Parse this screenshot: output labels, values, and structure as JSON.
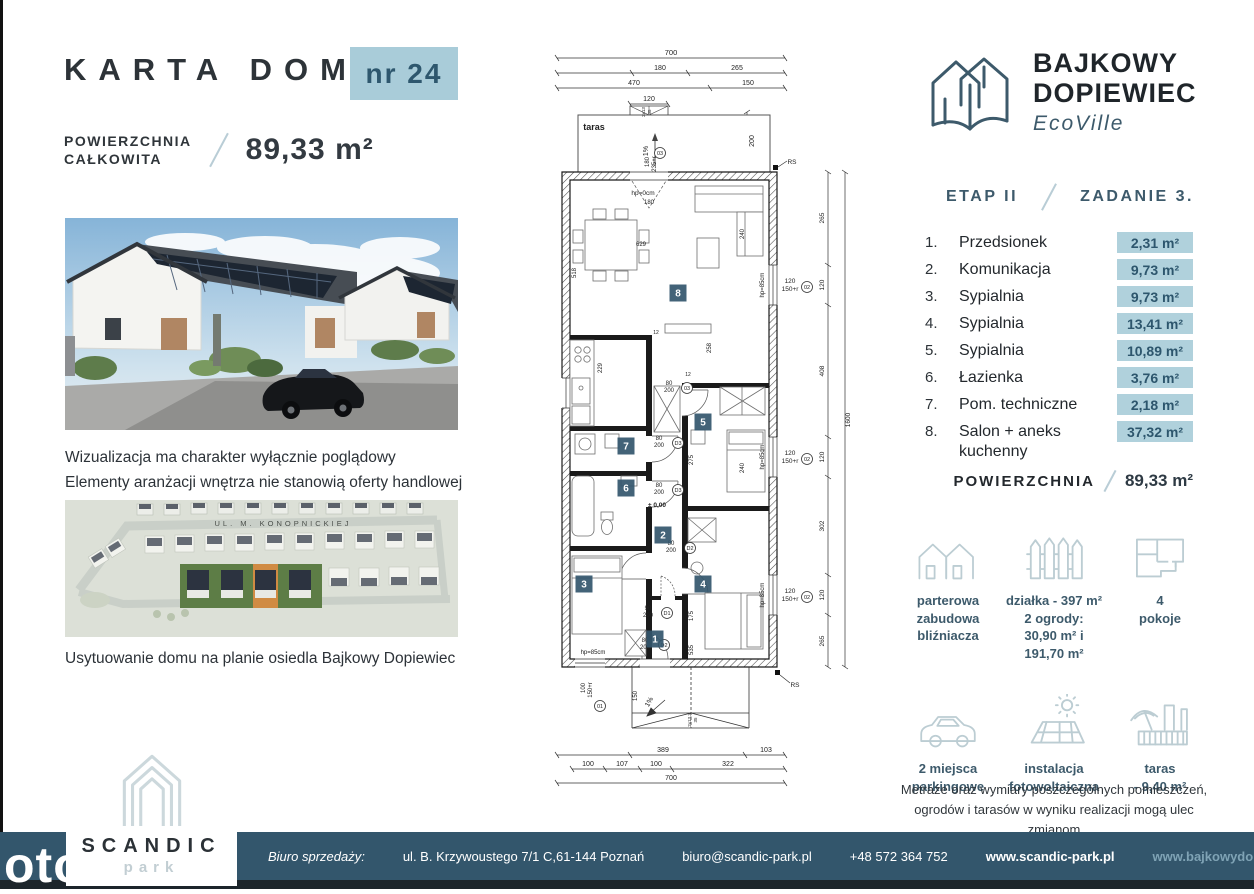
{
  "colors": {
    "accent_slate": "#3d5a6b",
    "badge_bg": "#a9ccd9",
    "badge_text": "#2e576e",
    "area_badge_bg": "#b0d1dc",
    "footer_bg": "#33566c",
    "icon_stroke": "#bccdd3",
    "plan_badge": "#33566c"
  },
  "header": {
    "title": "KARTA DOMU",
    "number_badge": "nr 24",
    "area_label": "POWIERZCHNIA\nCAŁKOWITA",
    "area_value": "89,33 m²"
  },
  "brand": {
    "name_line1": "BAJKOWY",
    "name_line2": "DOPIEWIEC",
    "sub": "EcoVille",
    "etap": "ETAP II",
    "zadanie": "ZADANIE 3."
  },
  "photo": {
    "caption": "Wizualizacja ma charakter wyłącznie poglądowy\nElementy aranżacji wnętrza nie stanowią oferty handlowej"
  },
  "siteplan": {
    "street": "UL. M. KONOPNICKIEJ",
    "caption": "Usytuowanie domu na planie osiedla Bajkowy Dopiewiec"
  },
  "rooms": [
    {
      "no": "1.",
      "name": "Przedsionek",
      "area": "2,31 m²"
    },
    {
      "no": "2.",
      "name": "Komunikacja",
      "area": "9,73 m²"
    },
    {
      "no": "3.",
      "name": "Sypialnia",
      "area": "9,73 m²"
    },
    {
      "no": "4.",
      "name": "Sypialnia",
      "area": "13,41 m²"
    },
    {
      "no": "5.",
      "name": "Sypialnia",
      "area": "10,89 m²"
    },
    {
      "no": "6.",
      "name": "Łazienka",
      "area": "3,76 m²"
    },
    {
      "no": "7.",
      "name": "Pom. techniczne",
      "area": "2,18 m²"
    },
    {
      "no": "8.",
      "name": "Salon + aneks kuchenny",
      "area": "37,32 m²"
    }
  ],
  "summary": {
    "label": "POWIERZCHNIA",
    "value": "89,33 m²"
  },
  "features": [
    {
      "icon": "twin-houses-icon",
      "caption": "parterowa\nzabudowa\nbliźniacza"
    },
    {
      "icon": "fence-icon",
      "caption": "działka - 397 m²\n2 ogrody:\n30,90 m² i 191,70 m²"
    },
    {
      "icon": "floorplan-icon",
      "caption": "4\npokoje"
    },
    {
      "icon": "car-icon",
      "caption": "2 miejsca\nparkingowe"
    },
    {
      "icon": "solar-panel-icon",
      "caption": "instalacja\nfotowoltaiczna"
    },
    {
      "icon": "terrace-umbrella-icon",
      "caption": "taras\n- 9,40 m²"
    }
  ],
  "disclaimer": "Metraże oraz wymiary poszczególnych pomieszczeń,\nogrodów i tarasów w wyniku realizacji mogą ulec zmianom",
  "footer": {
    "label": "Biuro sprzedaży:",
    "address": "ul. B. Krzywoustego 7/1 C,61-144 Poznań",
    "email": "biuro@scandic-park.pl",
    "phone": "+48 572 364 752",
    "site1": "www.scandic-park.pl",
    "site2": "www.bajkowydopiewiec.pl"
  },
  "scandic": {
    "name": "SCANDIC",
    "sub": "park"
  },
  "watermark": "oto",
  "plan": {
    "room_badges": [
      {
        "n": "1",
        "x": 110,
        "y": 601
      },
      {
        "n": "2",
        "x": 118,
        "y": 497
      },
      {
        "n": "3",
        "x": 39,
        "y": 546
      },
      {
        "n": "4",
        "x": 158,
        "y": 546
      },
      {
        "n": "5",
        "x": 158,
        "y": 384
      },
      {
        "n": "6",
        "x": 81,
        "y": 450
      },
      {
        "n": "7",
        "x": 81,
        "y": 408
      },
      {
        "n": "8",
        "x": 133,
        "y": 255
      }
    ],
    "circle_labels": [
      {
        "t": "03",
        "x": 115,
        "y": 115
      },
      {
        "t": "03",
        "x": 142,
        "y": 350
      },
      {
        "t": "02",
        "x": 262,
        "y": 249
      },
      {
        "t": "02",
        "x": 262,
        "y": 421
      },
      {
        "t": "02",
        "x": 262,
        "y": 559
      },
      {
        "t": "D3",
        "x": 133,
        "y": 405
      },
      {
        "t": "D3",
        "x": 133,
        "y": 452
      },
      {
        "t": "D2",
        "x": 145,
        "y": 510
      },
      {
        "t": "D1",
        "x": 122,
        "y": 575
      },
      {
        "t": "D2",
        "x": 119,
        "y": 607
      },
      {
        "t": "01",
        "x": 55,
        "y": 668
      }
    ],
    "texts": [
      {
        "t": "700",
        "x": 126,
        "y": 17,
        "s": 7.5
      },
      {
        "t": "180",
        "x": 115,
        "y": 32,
        "s": 7
      },
      {
        "t": "265",
        "x": 192,
        "y": 32,
        "s": 7
      },
      {
        "t": "470",
        "x": 89,
        "y": 47,
        "s": 7
      },
      {
        "t": "150",
        "x": 203,
        "y": 47,
        "s": 7
      },
      {
        "t": "120",
        "x": 104,
        "y": 63,
        "s": 7
      },
      {
        "t": "2x13",
        "x": 100,
        "y": 74,
        "s": 4.5,
        "r": -90
      },
      {
        "t": "35",
        "x": 106,
        "y": 74,
        "s": 4.5,
        "r": -90
      },
      {
        "t": "taras",
        "x": 49,
        "y": 92,
        "s": 9,
        "b": 1
      },
      {
        "t": "1%",
        "x": 103,
        "y": 113,
        "s": 7,
        "r": -90
      },
      {
        "t": "200",
        "x": 209,
        "y": 103,
        "s": 7,
        "r": -90
      },
      {
        "t": "180",
        "x": 104,
        "y": 124,
        "s": 6,
        "r": -90
      },
      {
        "t": "235+r",
        "x": 111,
        "y": 126,
        "s": 6,
        "r": -90
      },
      {
        "t": "hp=0cm",
        "x": 98,
        "y": 157,
        "s": 6.5
      },
      {
        "t": "180",
        "x": 104,
        "y": 166,
        "s": 6
      },
      {
        "t": "629",
        "x": 96,
        "y": 208,
        "s": 6
      },
      {
        "t": "518",
        "x": 31,
        "y": 235,
        "r": -90,
        "s": 6
      },
      {
        "t": "240",
        "x": 199,
        "y": 196,
        "r": -90,
        "s": 6
      },
      {
        "t": "258",
        "x": 166,
        "y": 310,
        "r": -90,
        "s": 6
      },
      {
        "t": "229",
        "x": 57,
        "y": 330,
        "r": -90,
        "s": 6
      },
      {
        "t": "275",
        "x": 148,
        "y": 422,
        "r": -90,
        "s": 6
      },
      {
        "t": "240",
        "x": 199,
        "y": 430,
        "r": -90,
        "s": 6
      },
      {
        "t": "175",
        "x": 148,
        "y": 578,
        "r": -90,
        "s": 6
      },
      {
        "t": "535",
        "x": 148,
        "y": 612,
        "r": -90,
        "s": 6
      },
      {
        "t": "12",
        "x": 143,
        "y": 338,
        "s": 5
      },
      {
        "t": "12",
        "x": 111,
        "y": 296,
        "s": 5
      },
      {
        "t": "120",
        "x": 245,
        "y": 245,
        "s": 6.5
      },
      {
        "t": "150+r",
        "x": 245,
        "y": 253,
        "s": 6.5
      },
      {
        "t": "hp=85cm",
        "x": 219,
        "y": 247,
        "s": 6,
        "r": -90
      },
      {
        "t": "120",
        "x": 245,
        "y": 417,
        "s": 6.5
      },
      {
        "t": "150+r",
        "x": 245,
        "y": 425,
        "s": 6.5
      },
      {
        "t": "hp=85cm",
        "x": 219,
        "y": 419,
        "s": 6,
        "r": -90
      },
      {
        "t": "120",
        "x": 245,
        "y": 555,
        "s": 6.5
      },
      {
        "t": "150+r",
        "x": 245,
        "y": 563,
        "s": 6.5
      },
      {
        "t": "hp=85cm",
        "x": 219,
        "y": 557,
        "s": 6,
        "r": -90
      },
      {
        "t": "RS",
        "x": 247,
        "y": 126,
        "s": 6.5
      },
      {
        "t": "RS",
        "x": 250,
        "y": 649,
        "s": 6.5
      },
      {
        "t": "265",
        "x": 279,
        "y": 180,
        "s": 6.5,
        "r": -90
      },
      {
        "t": "120",
        "x": 279,
        "y": 247,
        "s": 6.5,
        "r": -90
      },
      {
        "t": "408",
        "x": 279,
        "y": 333,
        "s": 6.5,
        "r": -90
      },
      {
        "t": "120",
        "x": 279,
        "y": 419,
        "s": 6.5,
        "r": -90
      },
      {
        "t": "302",
        "x": 279,
        "y": 488,
        "s": 6.5,
        "r": -90
      },
      {
        "t": "120",
        "x": 279,
        "y": 557,
        "s": 6.5,
        "r": -90
      },
      {
        "t": "265",
        "x": 279,
        "y": 603,
        "s": 6.5,
        "r": -90
      },
      {
        "t": "1600",
        "x": 305,
        "y": 382,
        "s": 6.5,
        "r": -90
      },
      {
        "t": "80",
        "x": 124,
        "y": 347,
        "s": 6
      },
      {
        "t": "200",
        "x": 124,
        "y": 354,
        "s": 6
      },
      {
        "t": "80",
        "x": 114,
        "y": 402,
        "s": 6
      },
      {
        "t": "200",
        "x": 114,
        "y": 409,
        "s": 6
      },
      {
        "t": "80",
        "x": 114,
        "y": 449,
        "s": 6
      },
      {
        "t": "200",
        "x": 114,
        "y": 456,
        "s": 6
      },
      {
        "t": "80",
        "x": 126,
        "y": 507,
        "s": 6
      },
      {
        "t": "200",
        "x": 126,
        "y": 514,
        "s": 6
      },
      {
        "t": "90",
        "x": 103,
        "y": 572,
        "s": 6
      },
      {
        "t": "200",
        "x": 103,
        "y": 579,
        "s": 6
      },
      {
        "t": "80",
        "x": 100,
        "y": 604,
        "s": 6
      },
      {
        "t": "200",
        "x": 100,
        "y": 611,
        "s": 6
      },
      {
        "t": "± 0,00",
        "x": 112,
        "y": 469,
        "s": 6.5,
        "b": 1
      },
      {
        "t": "hp=85cm",
        "x": 48,
        "y": 616,
        "s": 6
      },
      {
        "t": "100",
        "x": 40,
        "y": 650,
        "s": 6,
        "r": -90
      },
      {
        "t": "150+r",
        "x": 47,
        "y": 652,
        "s": 6,
        "r": -90
      },
      {
        "t": "1%",
        "x": 106,
        "y": 665,
        "s": 7,
        "r": -60
      },
      {
        "t": "150",
        "x": 92,
        "y": 658,
        "s": 6,
        "r": -90
      },
      {
        "t": "2x13,3",
        "x": 146,
        "y": 682,
        "s": 4.5,
        "r": -90
      },
      {
        "t": "35",
        "x": 152,
        "y": 682,
        "s": 4.5,
        "r": -90
      },
      {
        "t": "389",
        "x": 118,
        "y": 714,
        "s": 7
      },
      {
        "t": "103",
        "x": 221,
        "y": 714,
        "s": 7
      },
      {
        "t": "100",
        "x": 43,
        "y": 728,
        "s": 7
      },
      {
        "t": "107",
        "x": 77,
        "y": 728,
        "s": 7
      },
      {
        "t": "100",
        "x": 111,
        "y": 728,
        "s": 7
      },
      {
        "t": "322",
        "x": 183,
        "y": 728,
        "s": 7
      },
      {
        "t": "700",
        "x": 126,
        "y": 742,
        "s": 7
      }
    ]
  }
}
